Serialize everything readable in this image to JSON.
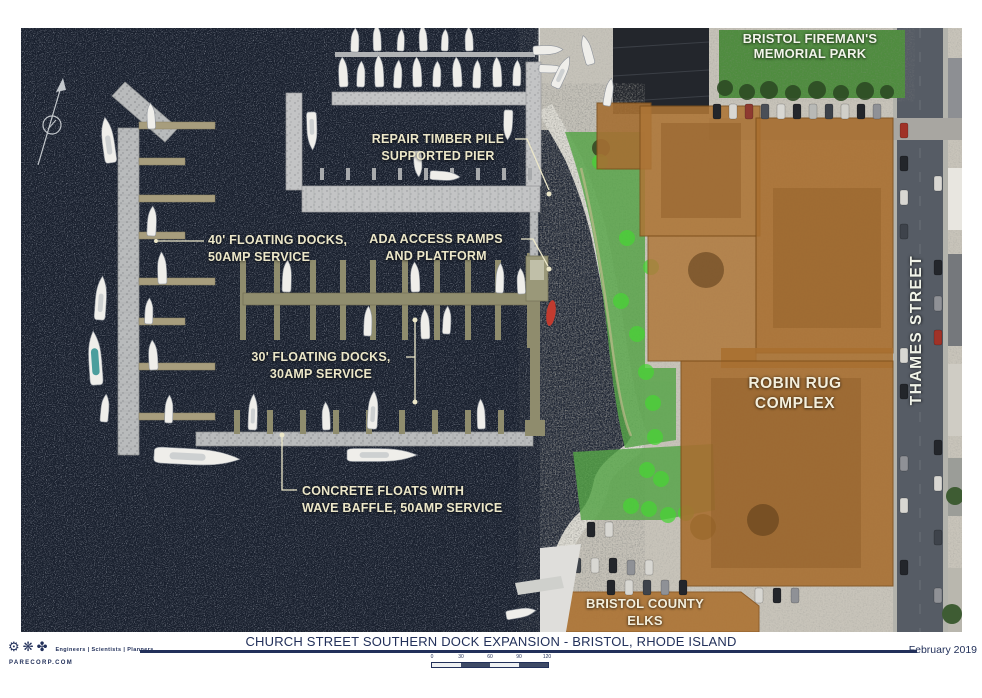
{
  "map": {
    "labels": {
      "memorial_park": {
        "line1": "BRISTOL FIREMAN'S",
        "line2": "MEMORIAL PARK"
      },
      "repair_pier": {
        "line1": "REPAIR TIMBER PILE",
        "line2": "SUPPORTED PIER"
      },
      "docks40": {
        "line1": "40' FLOATING DOCKS,",
        "line2": "50AMP SERVICE"
      },
      "ada": {
        "line1": "ADA ACCESS RAMPS",
        "line2": "AND PLATFORM"
      },
      "docks30": {
        "line1": "30' FLOATING DOCKS,",
        "line2": "30AMP SERVICE"
      },
      "concrete_floats": {
        "line1": "CONCRETE FLOATS WITH",
        "line2": "WAVE BAFFLE, 50AMP SERVICE"
      },
      "robin_rug": {
        "line1": "ROBIN RUG",
        "line2": "COMPLEX"
      },
      "thames_street": "THAMES STREET",
      "elks": {
        "line1": "BRISTOL COUNTY",
        "line2": "ELKS"
      }
    },
    "features": {
      "north_arrow": "compass-north-arrow",
      "water": "Bristol Harbor water",
      "proposed_docks_color": "#8f8c6d",
      "concrete_float_color": "#b9bbbc",
      "highlight_building_color": "#a96f30",
      "highlight_green_color": "#55a447",
      "label_color": "#ece7c9"
    }
  },
  "footer": {
    "title": "CHURCH STREET SOUTHERN DOCK EXPANSION - BRISTOL, RHODE ISLAND",
    "date": "February 2019",
    "logo": {
      "icons": [
        {
          "name": "gear-icon",
          "glyph": "⚙"
        },
        {
          "name": "snowflake-icon",
          "glyph": "❋"
        },
        {
          "name": "clover-icon",
          "glyph": "✤"
        }
      ],
      "tagline": "Engineers | Scientists | Planners",
      "website": "PARECORP.COM"
    },
    "scalebar": {
      "ticks": [
        "0",
        "30",
        "60",
        "90",
        "120"
      ]
    }
  }
}
